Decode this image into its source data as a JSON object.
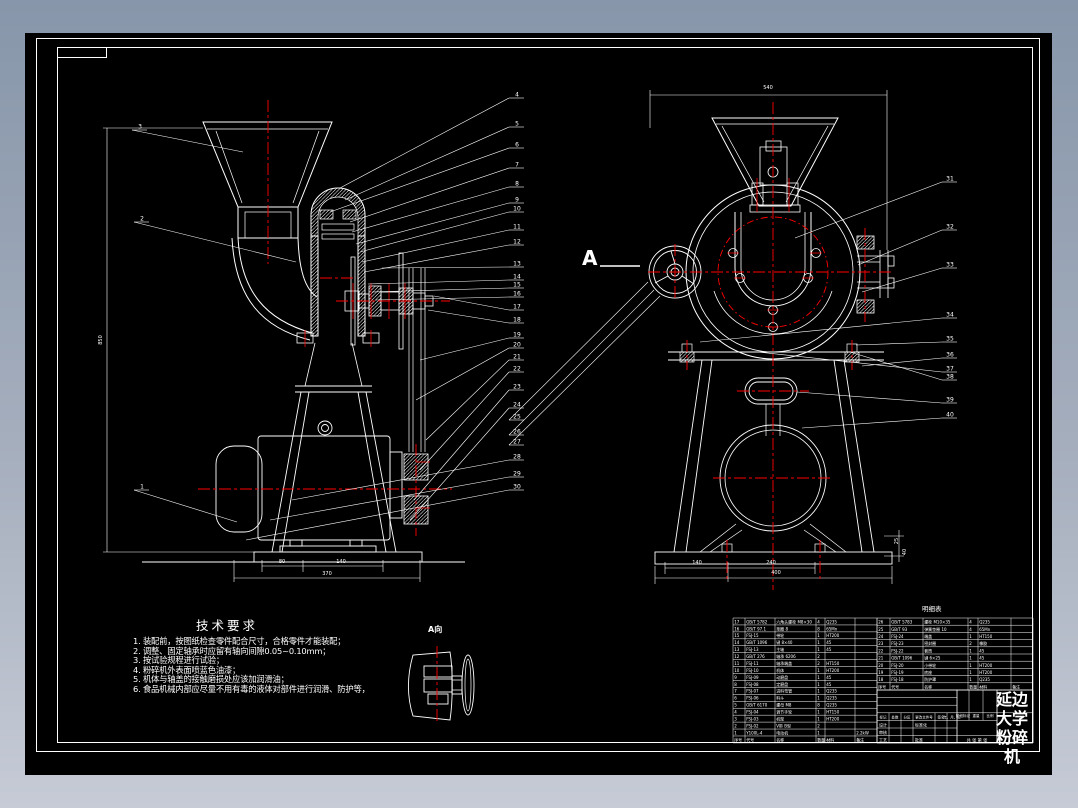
{
  "app": {
    "background_top": "#8796aa",
    "background_bottom": "#c6cbd6",
    "sheet_color": "#000000",
    "line_color": "#ffffff",
    "centerline_color": "#ff0000"
  },
  "tech_requirements": {
    "title": "技术要求",
    "items": [
      "1. 装配前，按图纸检查零件配合尺寸，合格零件才能装配；",
      "2. 调整、固定轴承时应留有轴向间隙0.05~0.10mm；",
      "3. 按试验规程进行试验；",
      "4. 粉碎机外表面喷蓝色油漆；",
      "5. 机体与轴盖的接触磨损处应该加润滑油；",
      "6. 食品机械内部应尽量不用有毒的液体对部件进行润滑、防护等，"
    ]
  },
  "labels": {
    "view_a": "A向",
    "section_arrow": "A",
    "parts_table_caption": "明细表"
  },
  "title_block": {
    "name_lines": [
      "延边",
      "大学",
      "粉碎",
      "机"
    ],
    "footer_labels": [
      "标记",
      "处数",
      "分区",
      "更改文件号",
      "签名",
      "年、月、日"
    ],
    "approval_rows": [
      [
        "设计",
        "标准化"
      ],
      [
        "审核",
        ""
      ],
      [
        "工艺",
        "批准"
      ]
    ],
    "stage_labels": [
      "阶段标记",
      "重量",
      "比例"
    ],
    "sheet_info": "共 张 第 张"
  },
  "parts_list": {
    "columns": [
      "序号",
      "代号",
      "名称",
      "数量",
      "材料",
      "备注"
    ],
    "left_rows": [
      [
        "17",
        "GB/T 5782",
        "六角头螺栓 M8×30",
        "4",
        "Q235",
        ""
      ],
      [
        "16",
        "GB/T 97.1",
        "垫圈 8",
        "8",
        "65Mn",
        ""
      ],
      [
        "15",
        "FSJ-15",
        "带轮",
        "1",
        "HT200",
        ""
      ],
      [
        "14",
        "GB/T 1096",
        "键 8×40",
        "1",
        "45",
        ""
      ],
      [
        "13",
        "FSJ-13",
        "主轴",
        "1",
        "45",
        ""
      ],
      [
        "12",
        "GB/T 276",
        "轴承 6206",
        "2",
        "",
        ""
      ],
      [
        "11",
        "FSJ-11",
        "轴承端盖",
        "2",
        "HT150",
        ""
      ],
      [
        "10",
        "FSJ-10",
        "机体",
        "1",
        "HT200",
        ""
      ],
      [
        "9",
        "FSJ-09",
        "动磨盘",
        "1",
        "45",
        ""
      ],
      [
        "8",
        "FSJ-08",
        "定磨盘",
        "1",
        "45",
        ""
      ],
      [
        "7",
        "FSJ-07",
        "进料弯管",
        "1",
        "Q235",
        ""
      ],
      [
        "6",
        "FSJ-06",
        "料斗",
        "1",
        "Q235",
        ""
      ],
      [
        "5",
        "GB/T 6170",
        "螺母 M8",
        "8",
        "Q235",
        ""
      ],
      [
        "4",
        "FSJ-04",
        "调节手轮",
        "1",
        "HT150",
        ""
      ],
      [
        "3",
        "FSJ-03",
        "机架",
        "1",
        "HT200",
        ""
      ],
      [
        "2",
        "FSJ-02",
        "V带 B型",
        "2",
        "",
        ""
      ],
      [
        "1",
        "Y100L-4",
        "电动机",
        "1",
        "",
        "2.2kW"
      ]
    ],
    "right_rows": [
      [
        "26",
        "GB/T 5783",
        "螺栓 M10×35",
        "4",
        "Q235",
        ""
      ],
      [
        "25",
        "GB/T 93",
        "弹簧垫圈 10",
        "4",
        "65Mn",
        ""
      ],
      [
        "24",
        "FSJ-24",
        "端盖",
        "1",
        "HT150",
        ""
      ],
      [
        "23",
        "FSJ-23",
        "密封圈",
        "2",
        "橡胶",
        ""
      ],
      [
        "22",
        "FSJ-22",
        "套筒",
        "1",
        "45",
        ""
      ],
      [
        "21",
        "GB/T 1096",
        "键 6×25",
        "1",
        "45",
        ""
      ],
      [
        "20",
        "FSJ-20",
        "小带轮",
        "1",
        "HT200",
        ""
      ],
      [
        "19",
        "FSJ-19",
        "底座",
        "1",
        "HT200",
        ""
      ],
      [
        "18",
        "FSJ-18",
        "防护罩",
        "1",
        "Q235",
        ""
      ]
    ]
  },
  "callouts": [
    {
      "n": "3",
      "x": 140,
      "y": 130,
      "tx": 243,
      "ty": 152
    },
    {
      "n": "2",
      "x": 142,
      "y": 222,
      "tx": 296,
      "ty": 262
    },
    {
      "n": "1",
      "x": 142,
      "y": 490,
      "tx": 237,
      "ty": 522
    },
    {
      "n": "4",
      "x": 517,
      "y": 98,
      "tx": 340,
      "ty": 188
    },
    {
      "n": "5",
      "x": 517,
      "y": 127,
      "tx": 345,
      "ty": 200
    },
    {
      "n": "6",
      "x": 517,
      "y": 148,
      "tx": 330,
      "ty": 212
    },
    {
      "n": "7",
      "x": 517,
      "y": 168,
      "tx": 350,
      "ty": 222
    },
    {
      "n": "8",
      "x": 517,
      "y": 187,
      "tx": 352,
      "ty": 232
    },
    {
      "n": "9",
      "x": 517,
      "y": 203,
      "tx": 356,
      "ty": 244
    },
    {
      "n": "10",
      "x": 517,
      "y": 212,
      "tx": 360,
      "ty": 252
    },
    {
      "n": "11",
      "x": 517,
      "y": 230,
      "tx": 362,
      "ty": 262
    },
    {
      "n": "12",
      "x": 517,
      "y": 245,
      "tx": 364,
      "ty": 272
    },
    {
      "n": "13",
      "x": 517,
      "y": 267,
      "tx": 382,
      "ty": 268
    },
    {
      "n": "14",
      "x": 517,
      "y": 280,
      "tx": 368,
      "ty": 284
    },
    {
      "n": "15",
      "x": 517,
      "y": 288,
      "tx": 372,
      "ty": 292
    },
    {
      "n": "16",
      "x": 517,
      "y": 297,
      "tx": 376,
      "ty": 300
    },
    {
      "n": "17",
      "x": 517,
      "y": 310,
      "tx": 434,
      "ty": 296
    },
    {
      "n": "18",
      "x": 517,
      "y": 323,
      "tx": 428,
      "ty": 310
    },
    {
      "n": "19",
      "x": 517,
      "y": 338,
      "tx": 420,
      "ty": 360
    },
    {
      "n": "20",
      "x": 517,
      "y": 348,
      "tx": 416,
      "ty": 400
    },
    {
      "n": "21",
      "x": 517,
      "y": 360,
      "tx": 426,
      "ty": 440
    },
    {
      "n": "22",
      "x": 517,
      "y": 372,
      "tx": 420,
      "ty": 470
    },
    {
      "n": "23",
      "x": 517,
      "y": 390,
      "tx": 414,
      "ty": 500
    },
    {
      "n": "24",
      "x": 517,
      "y": 408,
      "tx": 410,
      "ty": 520
    },
    {
      "n": "25",
      "x": 517,
      "y": 420,
      "tx": 648,
      "ty": 282
    },
    {
      "n": "26",
      "x": 517,
      "y": 435,
      "tx": 654,
      "ty": 290
    },
    {
      "n": "27",
      "x": 517,
      "y": 445,
      "tx": 660,
      "ty": 296
    },
    {
      "n": "28",
      "x": 517,
      "y": 460,
      "tx": 292,
      "ty": 500
    },
    {
      "n": "29",
      "x": 517,
      "y": 477,
      "tx": 270,
      "ty": 520
    },
    {
      "n": "30",
      "x": 517,
      "y": 490,
      "tx": 246,
      "ty": 540
    },
    {
      "n": "31",
      "x": 950,
      "y": 182,
      "tx": 795,
      "ty": 238
    },
    {
      "n": "32",
      "x": 950,
      "y": 230,
      "tx": 858,
      "ty": 265
    },
    {
      "n": "33",
      "x": 950,
      "y": 268,
      "tx": 862,
      "ty": 292
    },
    {
      "n": "34",
      "x": 950,
      "y": 318,
      "tx": 700,
      "ty": 342
    },
    {
      "n": "35",
      "x": 950,
      "y": 342,
      "tx": 856,
      "ty": 345
    },
    {
      "n": "36",
      "x": 950,
      "y": 358,
      "tx": 862,
      "ty": 366
    },
    {
      "n": "37",
      "x": 950,
      "y": 372,
      "tx": 758,
      "ty": 352
    },
    {
      "n": "38",
      "x": 950,
      "y": 380,
      "tx": 850,
      "ty": 352
    },
    {
      "n": "39",
      "x": 950,
      "y": 403,
      "tx": 797,
      "ty": 392
    },
    {
      "n": "40",
      "x": 950,
      "y": 418,
      "tx": 802,
      "ty": 428
    }
  ],
  "dimension_labels": [
    {
      "t": "850",
      "x": 102,
      "y": 340,
      "r": -90
    },
    {
      "t": "80",
      "x": 282,
      "y": 563
    },
    {
      "t": "140",
      "x": 341,
      "y": 563
    },
    {
      "t": "370",
      "x": 327,
      "y": 575
    },
    {
      "t": "540",
      "x": 768,
      "y": 89
    },
    {
      "t": "140",
      "x": 697,
      "y": 564
    },
    {
      "t": "240",
      "x": 771,
      "y": 564
    },
    {
      "t": "400",
      "x": 776,
      "y": 574
    },
    {
      "t": "25",
      "x": 898,
      "y": 541,
      "r": -90
    },
    {
      "t": "40",
      "x": 906,
      "y": 552,
      "r": -90
    }
  ]
}
